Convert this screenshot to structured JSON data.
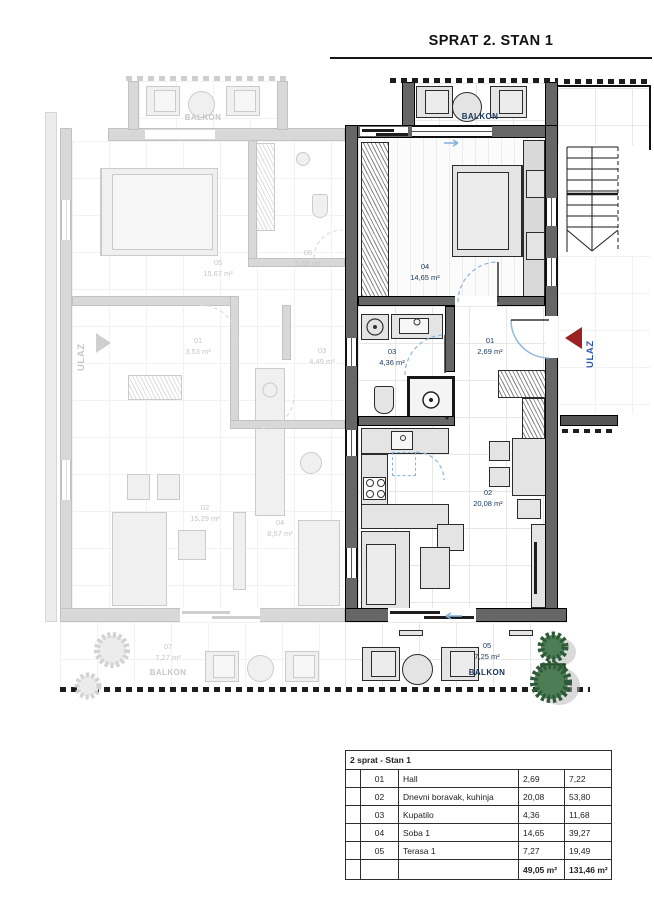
{
  "title": "SPRAT 2. STAN 1",
  "plan": {
    "active": {
      "ulaz": "ULAZ",
      "balkonTop": "BALKON",
      "soba": {
        "id": "04",
        "area": "14,65 m²"
      },
      "hall": {
        "id": "01",
        "area": "2,69 m²"
      },
      "kupatilo": {
        "id": "03",
        "area": "4,36 m²"
      },
      "dnevni": {
        "id": "02",
        "area": "20,08 m²"
      },
      "terasa": {
        "id": "05",
        "area": "7,25 m²",
        "name": "BALKON"
      }
    },
    "faded": {
      "ulaz": "ULAZ",
      "balkonTop": "BALKON",
      "soba": {
        "id": "05",
        "area": "15,67 m²"
      },
      "kupatilo": {
        "id": "06",
        "area": "5,09 m²"
      },
      "hall": {
        "id": "01",
        "area": "3,53 m²"
      },
      "ostava": {
        "id": "03",
        "area": "4,49 m²"
      },
      "dnevni": {
        "id": "02",
        "area": "15,29 m²"
      },
      "soba2": {
        "id": "04",
        "area": "8,57 m²"
      },
      "balkon": {
        "id": "07",
        "area": "7,27 m²",
        "name": "BALKON"
      }
    },
    "colors": {
      "activeWall": "#666666",
      "fadedWall": "#d8d8d8",
      "labelBlue": "#17365d",
      "ulazRed": "#9e2121",
      "ulazBlue": "#2c56b0",
      "doorArcBlue": "#8ab6dd",
      "treeGreen": "#4d7d55"
    }
  },
  "table": {
    "header": "2 sprat - Stan 1",
    "rows": [
      {
        "num": "01",
        "name": "Hall",
        "area": "2,69",
        "total": "7,22"
      },
      {
        "num": "02",
        "name": "Dnevni boravak, kuhinja",
        "area": "20,08",
        "total": "53,80"
      },
      {
        "num": "03",
        "name": "Kupatilo",
        "area": "4,36",
        "total": "11,68"
      },
      {
        "num": "04",
        "name": "Soba 1",
        "area": "14,65",
        "total": "39,27"
      },
      {
        "num": "05",
        "name": "Terasa 1",
        "area": "7,27",
        "total": "19,49"
      }
    ],
    "sum": {
      "area": "49,05 m²",
      "total": "131,46 m²"
    }
  }
}
